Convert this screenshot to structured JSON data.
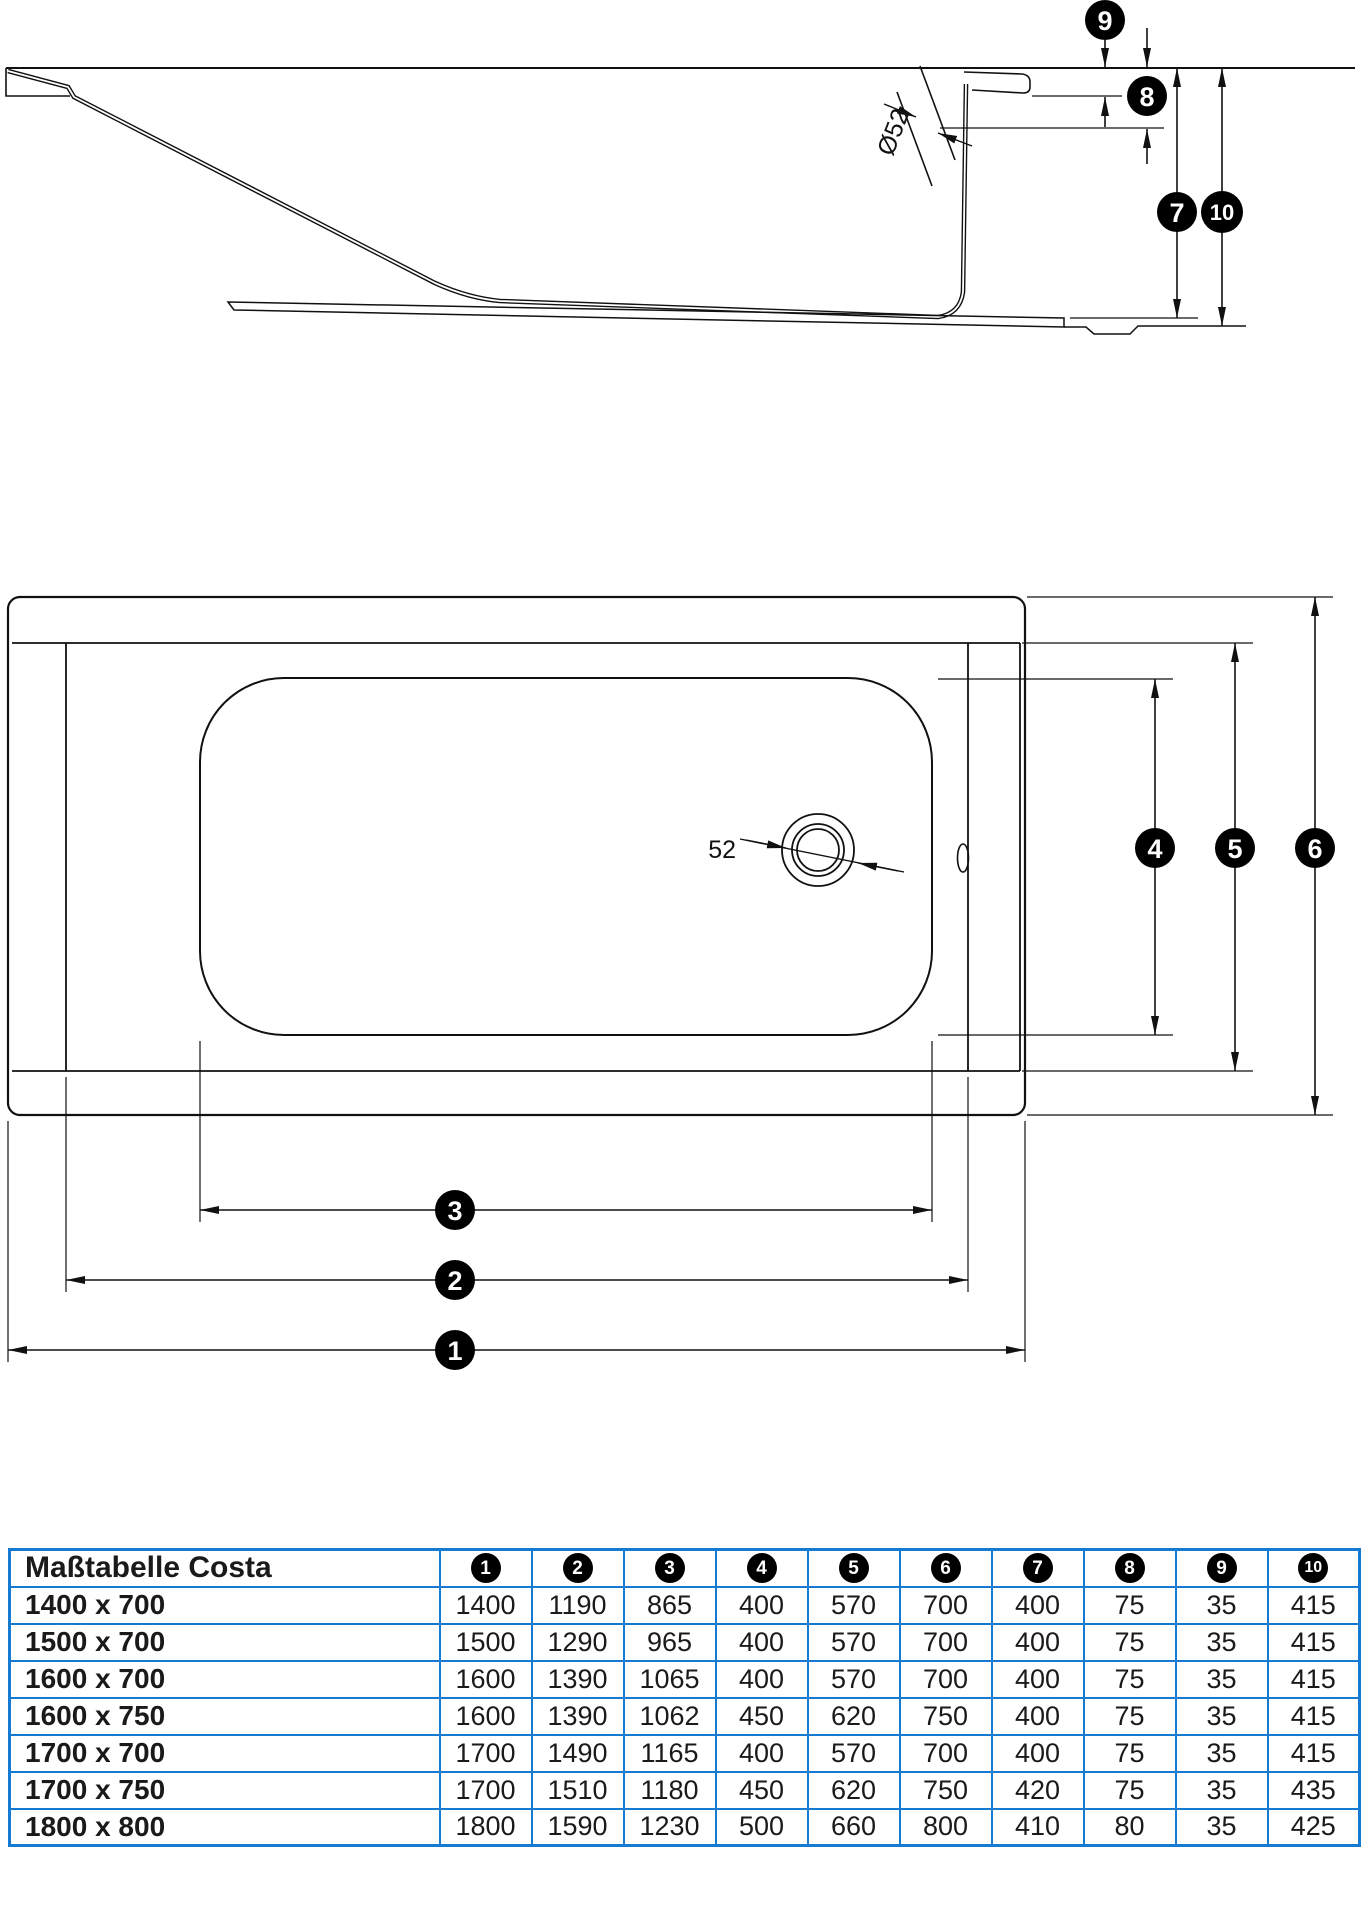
{
  "colors": {
    "line": "#111111",
    "table_border": "#147ad2",
    "badge_background": "#000000",
    "badge_text": "#ffffff"
  },
  "side_view": {
    "diameter_label": "Ø52",
    "callouts": {
      "c7": "7",
      "c8": "8",
      "c9": "9",
      "c10": "10"
    }
  },
  "top_view": {
    "drain_label": "52",
    "callouts": {
      "c1": "1",
      "c2": "2",
      "c3": "3",
      "c4": "4",
      "c5": "5",
      "c6": "6"
    }
  },
  "table": {
    "title": "Maßtabelle Costa",
    "columns": [
      "1",
      "2",
      "3",
      "4",
      "5",
      "6",
      "7",
      "8",
      "9",
      "10"
    ],
    "rows": [
      {
        "size": "1400 x 700",
        "values": [
          "1400",
          "1190",
          "865",
          "400",
          "570",
          "700",
          "400",
          "75",
          "35",
          "415"
        ]
      },
      {
        "size": "1500 x 700",
        "values": [
          "1500",
          "1290",
          "965",
          "400",
          "570",
          "700",
          "400",
          "75",
          "35",
          "415"
        ]
      },
      {
        "size": "1600 x 700",
        "values": [
          "1600",
          "1390",
          "1065",
          "400",
          "570",
          "700",
          "400",
          "75",
          "35",
          "415"
        ]
      },
      {
        "size": "1600 x 750",
        "values": [
          "1600",
          "1390",
          "1062",
          "450",
          "620",
          "750",
          "400",
          "75",
          "35",
          "415"
        ]
      },
      {
        "size": "1700 x 700",
        "values": [
          "1700",
          "1490",
          "1165",
          "400",
          "570",
          "700",
          "400",
          "75",
          "35",
          "415"
        ]
      },
      {
        "size": "1700 x 750",
        "values": [
          "1700",
          "1510",
          "1180",
          "450",
          "620",
          "750",
          "420",
          "75",
          "35",
          "435"
        ]
      },
      {
        "size": "1800 x 800",
        "values": [
          "1800",
          "1590",
          "1230",
          "500",
          "660",
          "800",
          "410",
          "80",
          "35",
          "425"
        ]
      }
    ]
  }
}
